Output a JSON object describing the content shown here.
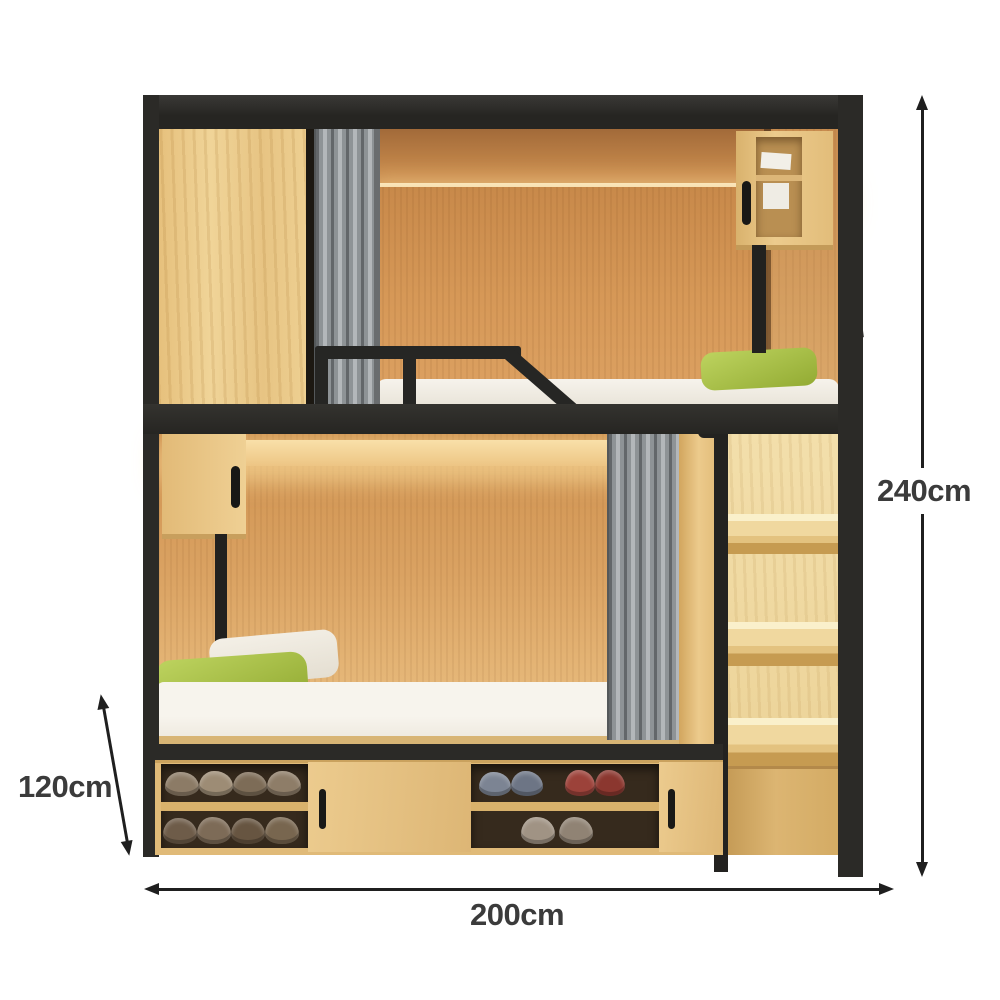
{
  "meta": {
    "subject": "loft bunk capsule bed with storage staircase, wardrobe, curtains and shoe cabinet",
    "style": "product dimension photo on white background"
  },
  "annotations": {
    "height": {
      "label": "240cm",
      "orientation": "vertical",
      "position": "right"
    },
    "depth": {
      "label": "120cm",
      "orientation": "diagonal",
      "position": "bottom-left"
    },
    "width": {
      "label": "200cm",
      "orientation": "horizontal",
      "position": "bottom"
    }
  },
  "palette": {
    "background": "#ffffff",
    "frame_black": "#2b2a27",
    "wood_light": "#ecca8c",
    "wood_interior": "#d69857",
    "curtain_gray": "#8e9396",
    "mattress_white": "#f4f1e9",
    "pillow_green": "#a4bd48",
    "led_glow": "#fbe7bb",
    "annotation_text": "#3b3b3b",
    "annotation_line": "#1f1f1f",
    "shoe_browns": [
      "#8c7b66",
      "#9d8c75",
      "#7d6c57",
      "#6e5c49"
    ],
    "shoe_grayblue": "#7c8493",
    "shoe_red": "#9c423a"
  },
  "parts": [
    "top wardrobe cabinet",
    "upper privacy curtain",
    "upper bunk guardrail",
    "upper wall cubby",
    "led cabin lighting",
    "upper mattress with green pillow",
    "lower wall cubby",
    "lower privacy curtain",
    "lower mattress with pillows",
    "staircase shelf ladder with handrail",
    "under-stair cabinet",
    "shoe storage bays",
    "sliding cabinet doors"
  ]
}
